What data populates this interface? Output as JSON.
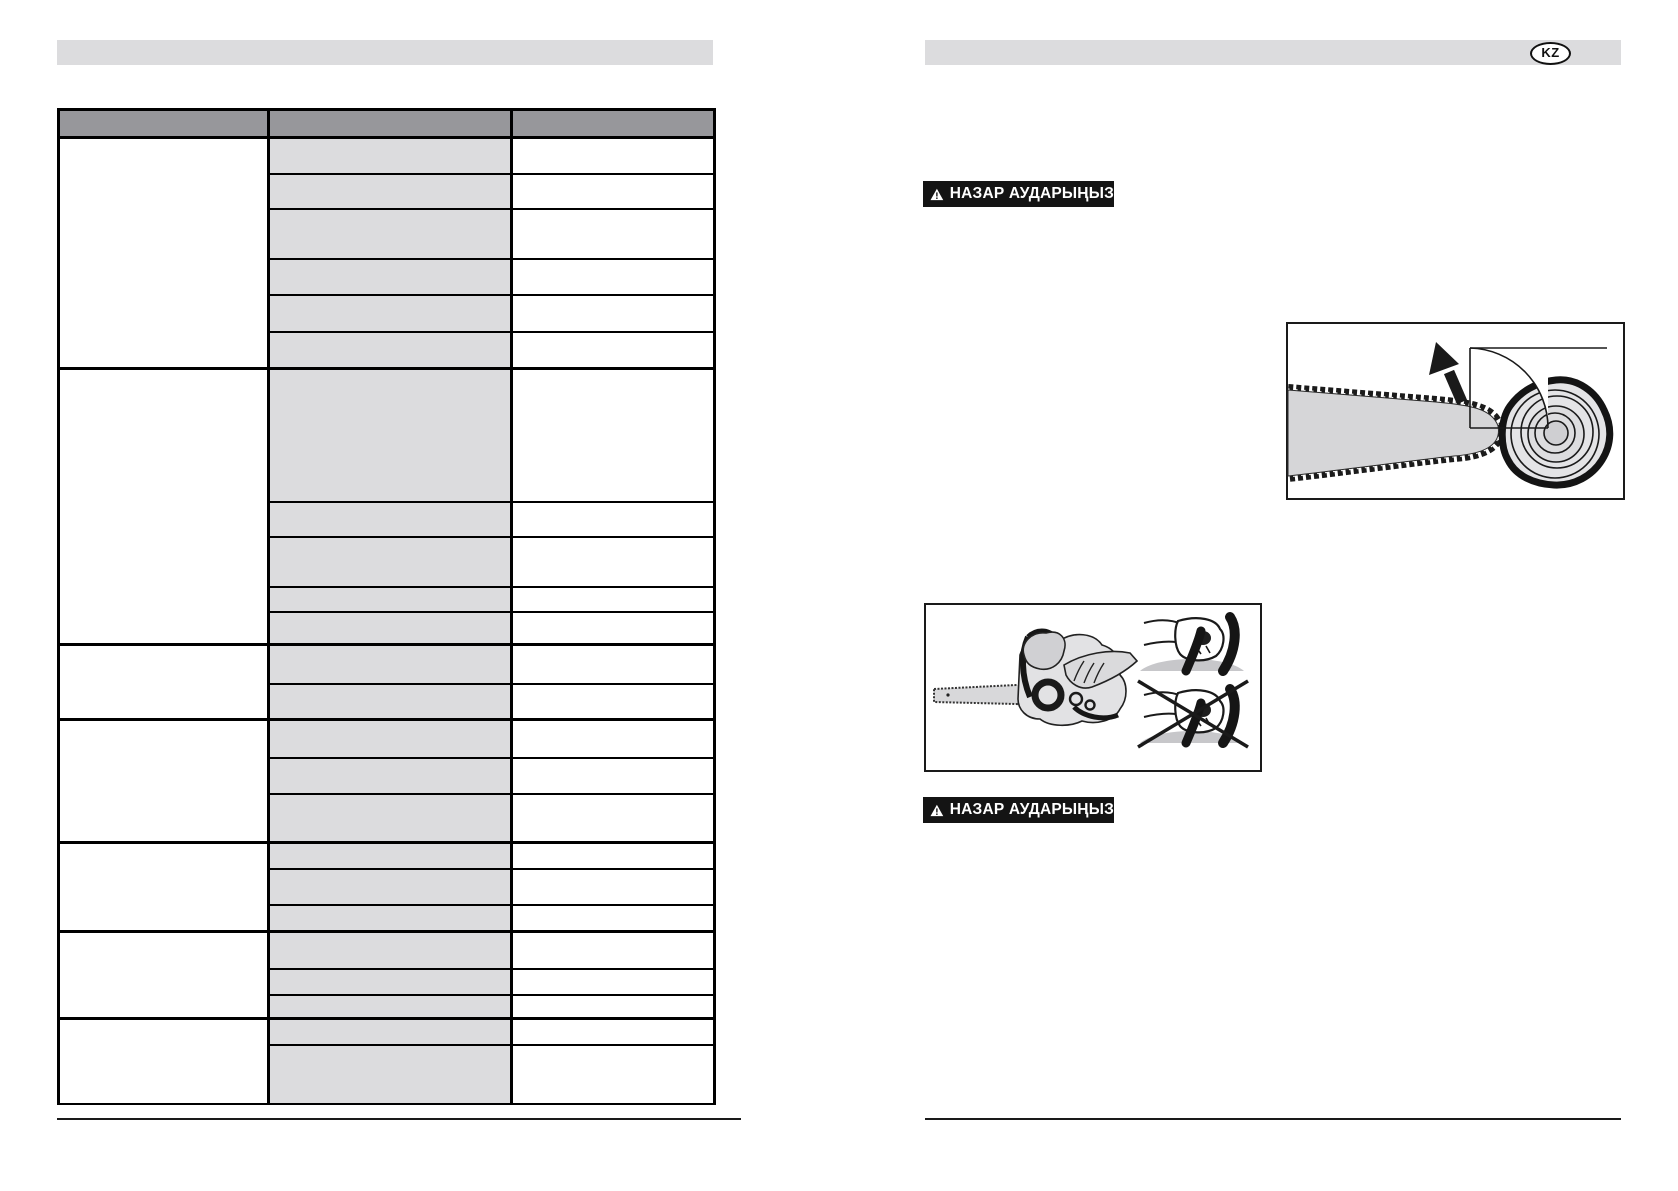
{
  "right_page": {
    "language_badge": "KZ",
    "warning_banners": [
      {
        "label": "НАЗАР АУДАРЫҢЫЗ"
      },
      {
        "label": "НАЗАР АУДАРЫҢЫЗ"
      }
    ],
    "illustrations": [
      {
        "name": "chainsaw-bar-kickback-log-diagram"
      },
      {
        "name": "chainsaw-grip-correct-vs-incorrect-diagram"
      }
    ]
  },
  "left_page": {
    "title_bar_text": "",
    "table": {
      "header_labels": [
        "",
        "",
        ""
      ],
      "column_widths": [
        210,
        243,
        203
      ],
      "header_height": 28,
      "cells_empty": true,
      "groups": [
        {
          "row_heights": [
            36,
            35,
            50,
            36,
            37,
            37
          ]
        },
        {
          "row_heights": [
            133,
            35,
            50,
            25,
            33
          ]
        },
        {
          "row_heights": [
            39,
            36
          ]
        },
        {
          "row_heights": [
            38,
            36,
            49
          ]
        },
        {
          "row_heights": [
            26,
            36,
            27
          ]
        },
        {
          "row_heights": [
            37,
            26,
            24
          ]
        },
        {
          "row_heights": [
            26,
            59
          ]
        }
      ]
    }
  },
  "colors": {
    "page_bg": "#ffffff",
    "title_bar_gray": "#dcdcde",
    "table_header_gray": "#97979b",
    "table_cell_gray": "#dcdcde",
    "banner_bg": "#141414",
    "banner_text": "#ffffff",
    "line_black": "#000000",
    "drawing_gray": "#d6d6d8"
  }
}
